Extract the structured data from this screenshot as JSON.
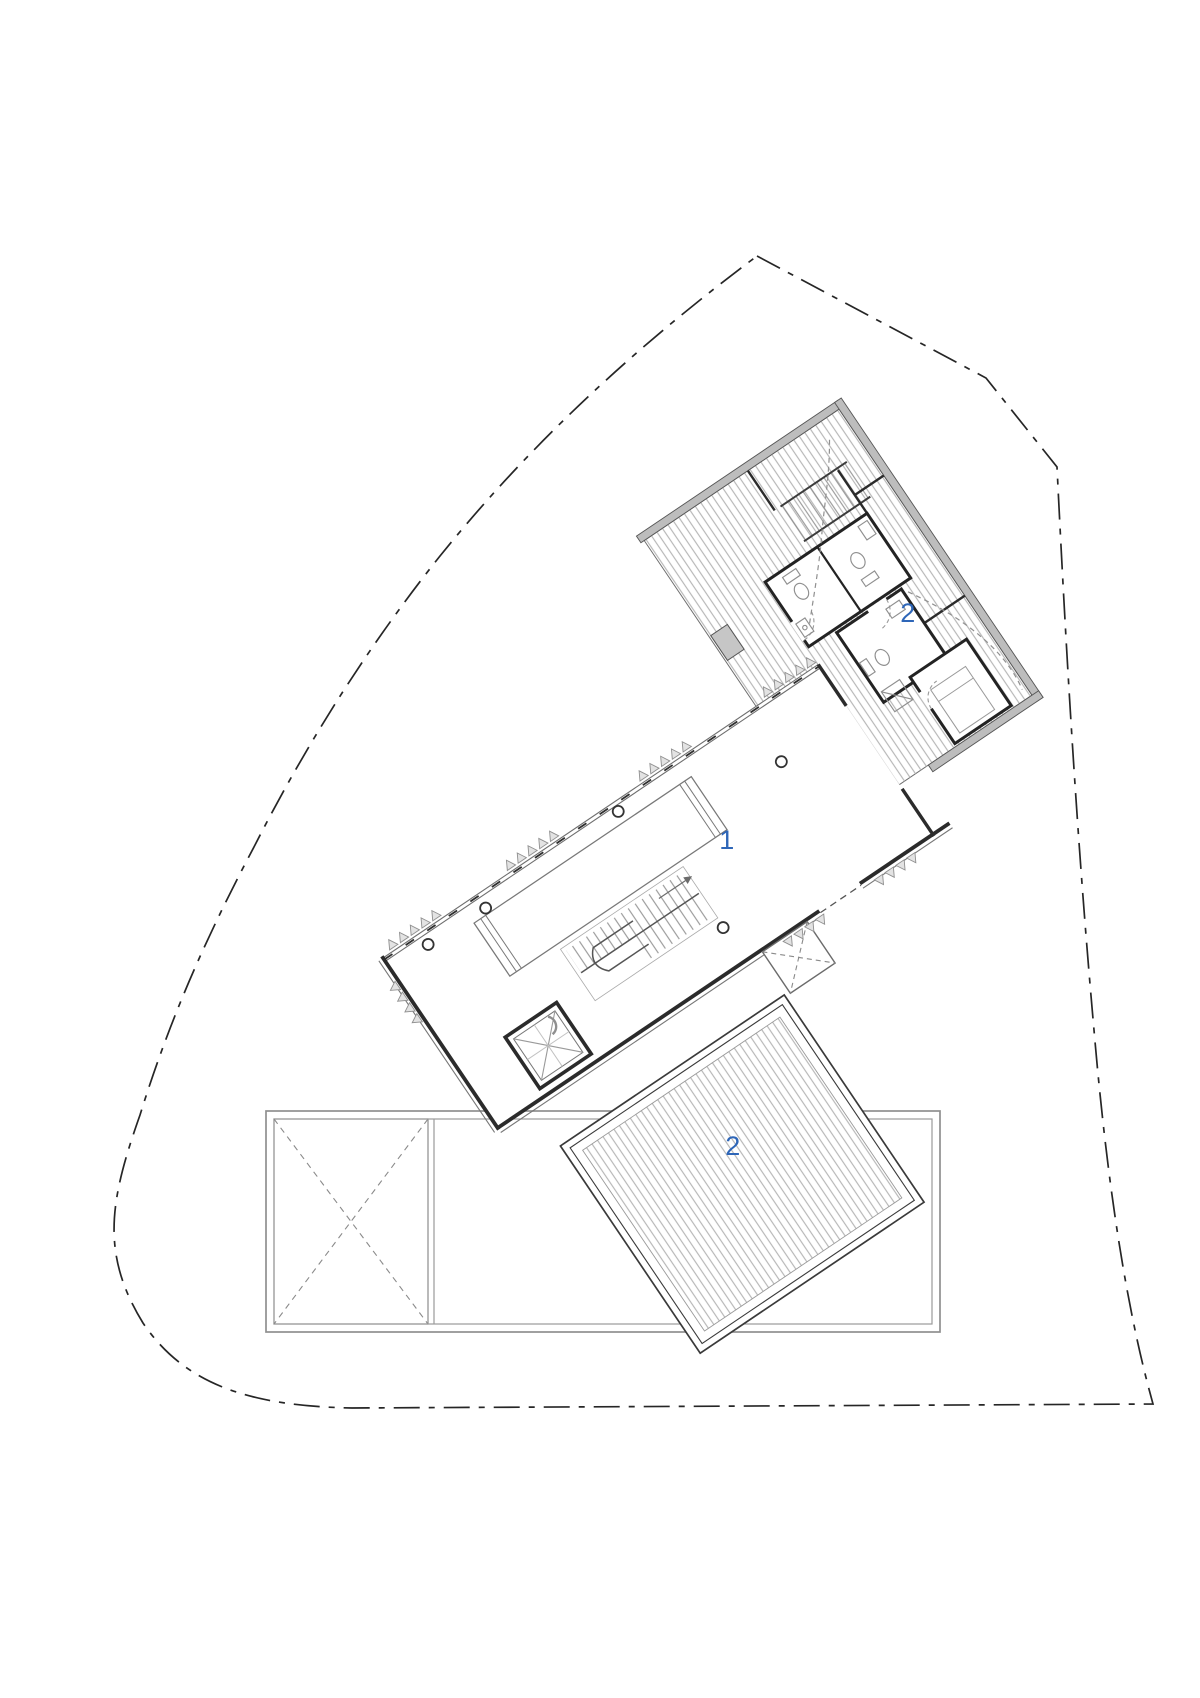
{
  "plan": {
    "canvas": {
      "width": 1200,
      "height": 1698
    },
    "labels": [
      {
        "id": "main-hall",
        "text": "1",
        "x": 727,
        "y": 849
      },
      {
        "id": "upper-deck",
        "text": "2",
        "x": 908,
        "y": 622
      },
      {
        "id": "lower-deck",
        "text": "2",
        "x": 733,
        "y": 1155
      }
    ],
    "palette": {
      "label_blue": "#2e66b8",
      "wall_dark": "#2b2b2b",
      "line_gray": "#8f8f8f",
      "hatch_gray": "#b6b6b6",
      "deck_edge_gray": "#bdbdbd",
      "boundary_dark": "#262626",
      "background": "#ffffff"
    }
  }
}
